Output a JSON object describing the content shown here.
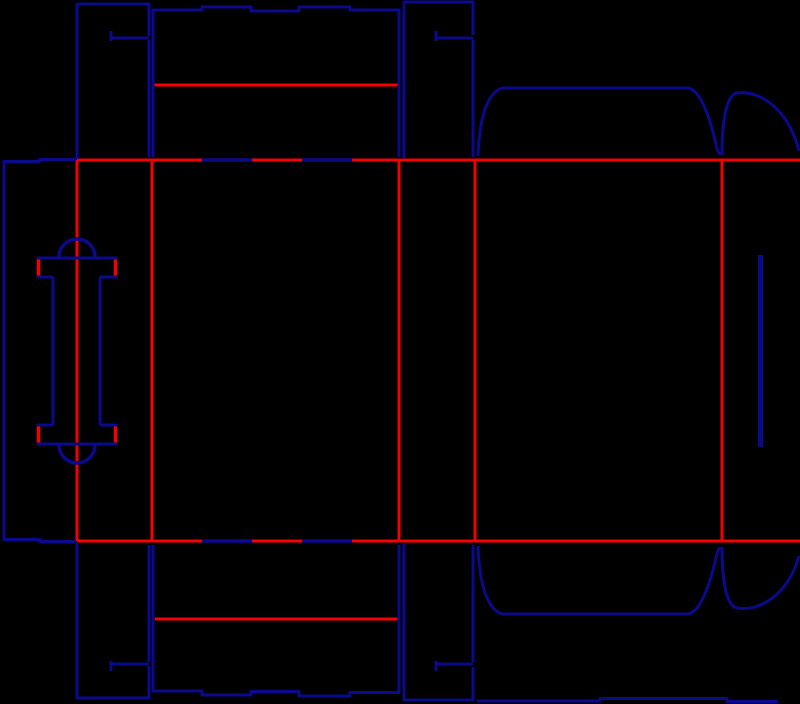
{
  "diagram": {
    "canvas": {
      "width": 800,
      "height": 704,
      "background": "#000000"
    },
    "colors": {
      "cut": "#0a0a8c",
      "crease": "#f40000"
    },
    "default_stroke_width": 3,
    "crease_lines": [
      {
        "name": "top-crease",
        "d": "M 77,160 L 800,160"
      },
      {
        "name": "bottom-crease",
        "d": "M 77,541 L 800,541"
      },
      {
        "name": "vertical-crease-glue",
        "d": "M 77,160 L 77,541"
      },
      {
        "name": "vertical-crease-side1",
        "d": "M 152,160 L 152,541"
      },
      {
        "name": "vertical-crease-front",
        "d": "M 399,160 L 399,541"
      },
      {
        "name": "vertical-crease-side2",
        "d": "M 475,160 L 475,541"
      },
      {
        "name": "vertical-crease-back",
        "d": "M 722,160 L 722,541"
      },
      {
        "name": "top-tuck-flap-crease",
        "d": "M 153,85 L 398,85"
      },
      {
        "name": "bottom-tuck-flap-crease",
        "d": "M 155,619 L 399,619"
      },
      {
        "name": "handle-fold-tick-top-left",
        "d": "M 38.5,257 L 38.5,278",
        "w": 3.5
      },
      {
        "name": "handle-fold-tick-top-right",
        "d": "M 115.5,257 L 115.5,278",
        "w": 3.5
      },
      {
        "name": "handle-fold-tick-bottom-left",
        "d": "M 38.5,424 L 38.5,445",
        "w": 3.5
      },
      {
        "name": "handle-fold-tick-bottom-right",
        "d": "M 115.5,424 L 115.5,445",
        "w": 3.5
      }
    ],
    "cut_lines": [
      {
        "name": "glue-panel-outline",
        "d": "M 76,159.5 L 40,159.5 L 40,161.5 L 4,161.5 L 4,539.5 L 40,539.5 L 40,541.5 L 76,541.5"
      },
      {
        "name": "strip1-top-outline",
        "d": "M 77,159 L 77,4 L 149,4 L 149,36"
      },
      {
        "name": "strip1-top-slit",
        "d": "M 149,38 L 111,38"
      },
      {
        "name": "strip1-top-slit-tick",
        "d": "M 111,31 L 111,41"
      },
      {
        "name": "strip1-top-right-edge",
        "d": "M 149,40 L 149,157"
      },
      {
        "name": "top-tuck-flap-outline",
        "d": "M 153,157 L 153,10 L 202,10 L 202,7 L 251,7 L 251,11 L 299,11 L 299,7 L 350,7 L 350,10 L 399,10 L 399,157"
      },
      {
        "name": "strip2-top-outline",
        "d": "M 404,158 L 404,2 L 473,2 L 473,35"
      },
      {
        "name": "strip2-top-slit",
        "d": "M 473,38 L 436,38"
      },
      {
        "name": "strip2-top-slit-tick",
        "d": "M 436,31 L 436,41"
      },
      {
        "name": "strip2-top-right-edge",
        "d": "M 473,40 L 473,157"
      },
      {
        "name": "back-top-dust-flap",
        "d": "M 478,156 C 479,128 484,94 502,88 L 688,88 C 702,90 712,125 717,149 L 720,155"
      },
      {
        "name": "right-top-dust-flap",
        "d": "M 722,155 C 722,118 727,95 737,93 C 758,90 788,107 799,151"
      },
      {
        "name": "back-bottom-dust-flap",
        "d": "M 478,546 C 479,574 484,608 502,614 L 688,614 C 702,612 712,577 717,553 L 720,547"
      },
      {
        "name": "right-bottom-dust-flap",
        "d": "M 722,547 C 722,584 727,606 737,608 C 758,612 788,596 799,556"
      },
      {
        "name": "bottom-tuck-flap-outline",
        "d": "M 153,545 L 153,691 L 202,691 L 202,695 L 251,695 L 251,691.5 L 299,691.5 L 299,696 L 350,696 L 350,692.5 L 399,692.5 L 399,545"
      },
      {
        "name": "strip1-bottom-outline",
        "d": "M 77,543 L 77,698 L 149,698 L 149,666"
      },
      {
        "name": "strip1-bottom-slit",
        "d": "M 149,664 L 111,664"
      },
      {
        "name": "strip1-bottom-slit-tick",
        "d": "M 111,661 L 111,671"
      },
      {
        "name": "strip1-bottom-right-edge",
        "d": "M 149,662 L 149,545"
      },
      {
        "name": "strip2-bottom-outline",
        "d": "M 404,544 L 404,700 L 473,700 L 473,667"
      },
      {
        "name": "strip2-bottom-slit",
        "d": "M 473,664 L 436,664"
      },
      {
        "name": "strip2-bottom-slit-tick",
        "d": "M 436,661 L 436,671"
      },
      {
        "name": "strip2-bottom-right-edge",
        "d": "M 473,662 L 473,545"
      },
      {
        "name": "bottom-right-panel-edge",
        "d": "M 477,701 L 600,701 L 600,698.5 L 727,698.5 L 727,701.5 L 778,701.5"
      },
      {
        "name": "right-panel-slot",
        "d": "M 760.5,255 L 760.5,447",
        "w": 5
      },
      {
        "name": "handle-top-arc",
        "d": "M 59,257 A 18,18 0 0 1 95,257",
        "w": 3.5
      },
      {
        "name": "handle-top-bar",
        "d": "M 37,258 L 117,258"
      },
      {
        "name": "handle-inner-top-left",
        "d": "M 37,277 L 53,277"
      },
      {
        "name": "handle-inner-top-right",
        "d": "M 100,277 L 117,277"
      },
      {
        "name": "handle-stem-left",
        "d": "M 53,277 L 53,425"
      },
      {
        "name": "handle-stem-right",
        "d": "M 100,277 L 100,425"
      },
      {
        "name": "handle-inner-bottom-left",
        "d": "M 37,425 L 53,425"
      },
      {
        "name": "handle-inner-bottom-right",
        "d": "M 100,425 L 117,425"
      },
      {
        "name": "handle-bottom-bar",
        "d": "M 37,444 L 117,444"
      },
      {
        "name": "handle-bottom-arc",
        "d": "M 59,445 A 18,18 0 0 0 95,445",
        "w": 3.5
      },
      {
        "name": "front-top-crease-dash-1",
        "d": "M 202,160 L 252,160",
        "w": 3.5
      },
      {
        "name": "front-top-crease-dash-2",
        "d": "M 302,160 L 352,160",
        "w": 3.5
      },
      {
        "name": "front-bottom-crease-dash-1",
        "d": "M 202,541 L 252,541",
        "w": 3.5
      },
      {
        "name": "front-bottom-crease-dash-2",
        "d": "M 302,541 L 352,541",
        "w": 3.5
      }
    ]
  }
}
